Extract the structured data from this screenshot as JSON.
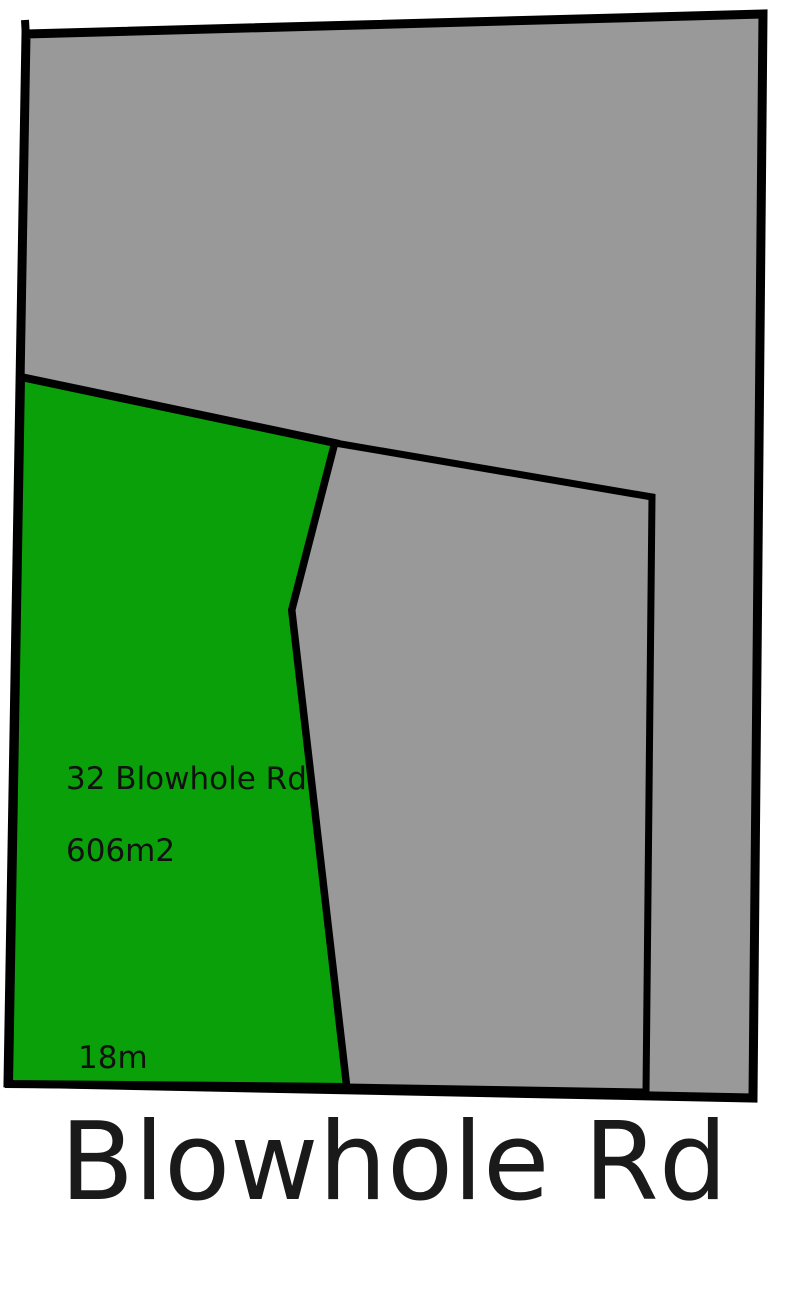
{
  "map": {
    "street_label": "Blowhole Rd",
    "highlighted_lot": {
      "address_label": "32 Blowhole Rd",
      "area_label": "606m2",
      "frontage_label": "18m"
    },
    "colors": {
      "highlight_green": "#0aa00a",
      "parcel_gray": "#999999",
      "boundary_black": "#000000",
      "background_white": "#ffffff"
    }
  }
}
